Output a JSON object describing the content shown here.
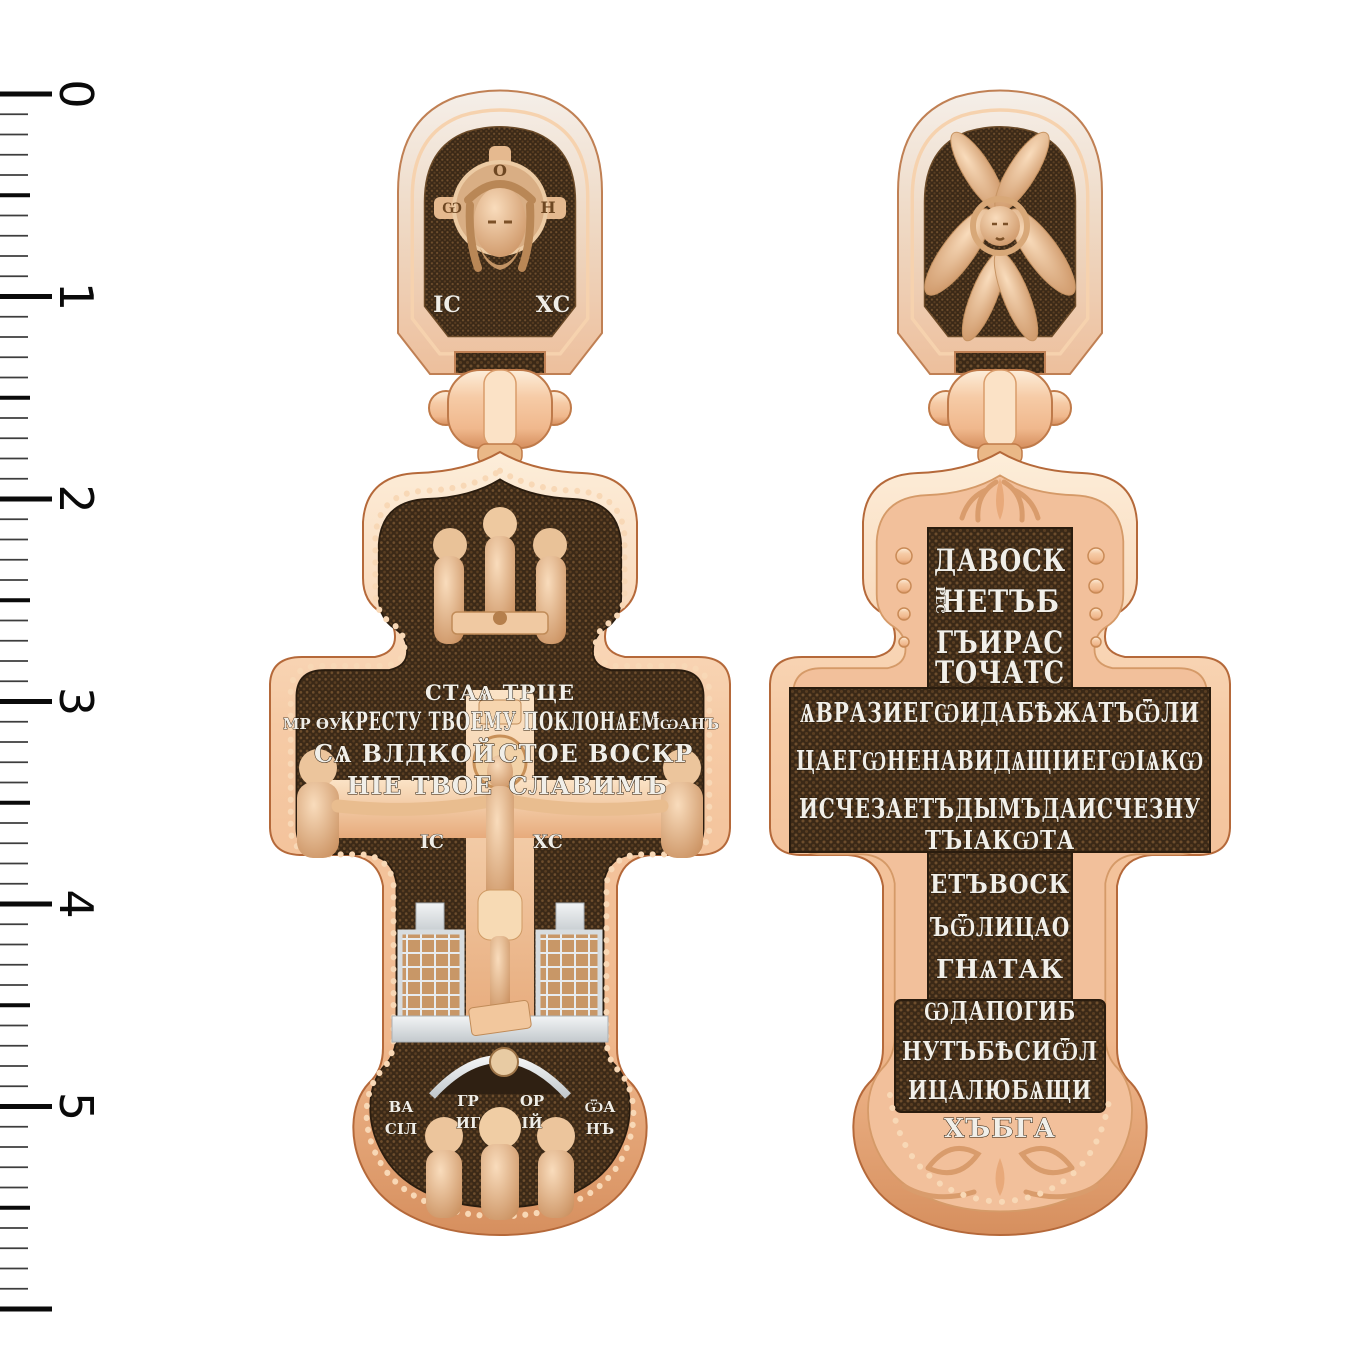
{
  "meta": {
    "subject_front": "orthodox-cross-pendant-front",
    "subject_back": "orthodox-cross-pendant-back"
  },
  "ruler": {
    "labels": [
      "0",
      "1",
      "2",
      "3",
      "4",
      "5"
    ],
    "major_ticks": 7,
    "minor_per_unit": 10
  },
  "colors": {
    "background": "#ffffff",
    "gold_light": "#fdeeda",
    "gold_mid": "#f4c29c",
    "gold_dark": "#d68f5e",
    "gold_edge": "#b5693a",
    "panel_brown": "#3b2917",
    "panel_dot": "#6e4e2d",
    "silver_text": "#f1efe9",
    "silver_relief": "#e8ecef",
    "ruler_black": "#0a0a0a"
  },
  "front": {
    "bail": {
      "icon": "holy-face-icon",
      "halo_letter_left": "Ѡ",
      "halo_letter_top": "О",
      "halo_letter_right": "Н",
      "monogram_left": "ІС",
      "monogram_right": "ХС"
    },
    "top_icon": "holy-trinity-icon",
    "caption": "СТАѦ ТРЦЕ",
    "inscription": {
      "left_abbr": "МР ѲУ",
      "line1": "КРЕСТУ ТВОЕМУ ПОКЛОНѦЕМ",
      "right_abbr": "ІѠАНЪ",
      "line2_left": "СѦ ВЛДКОЙ",
      "line2_right": "СТОЕ ВОСКР",
      "line3_left": "НІЕ ТВОЕ",
      "line3_right": "СЛАВИМЪ"
    },
    "christ_monogram_left": "ІС",
    "christ_monogram_right": "ХС",
    "saints": [
      {
        "top": "ВА",
        "bottom": "СІЛ"
      },
      {
        "top": "ГР",
        "bottom": "ИГ"
      },
      {
        "top": "ОР",
        "bottom": "ІЙ"
      },
      {
        "top": "ѾА",
        "bottom": "НЪ"
      }
    ]
  },
  "back": {
    "bail_icon": "seraph-icon",
    "top_lines": [
      "ДАВОСК",
      "НЕТЪБ",
      "ГЪИРАС",
      "ТОЧАТС"
    ],
    "side_small": "РЕС",
    "beam_lines": [
      "ѦВРАЗИЕГѠИДАБѢЖАТЪѾЛИ",
      "ЦАЕГѠНЕНАВИДѦЩІИЕГѠІѦКѠ",
      "ИСЧЕЗАЕТЪДЫМЪДАИСЧЕЗНУ"
    ],
    "lower_lines": [
      "ТЪІАКѠТА",
      "ЕТЪВОСК",
      "ЪѾЛИЦАО",
      "ГНѦТАК",
      "ѠДАПОГИБ",
      "НУТЪБѢСИѾЛ",
      "ИЦАЛЮБѦЩИ",
      "ХЪБГА"
    ]
  }
}
